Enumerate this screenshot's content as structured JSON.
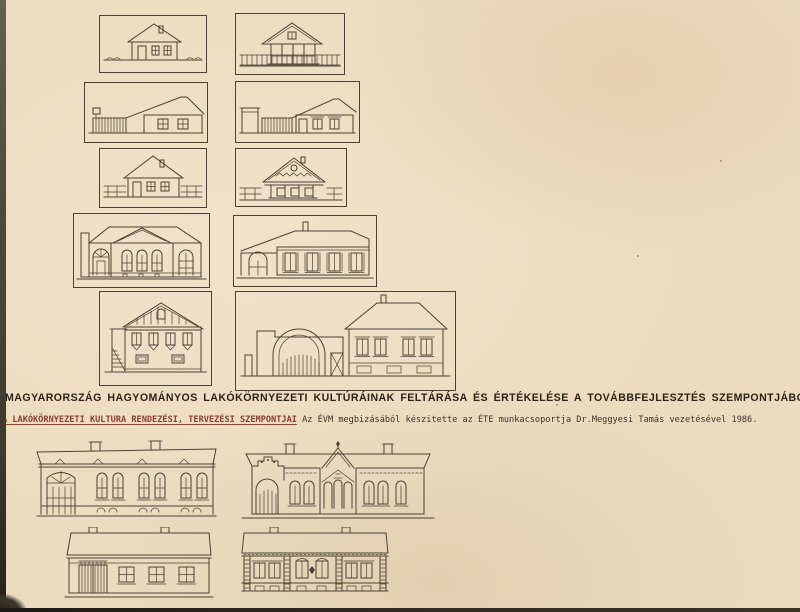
{
  "title": {
    "line1": "MAGYARORSZÁG HAGYOMÁNYOS LAKÓKÖRNYEZETI KULTÚRÁINAK FELTÁRÁSA ÉS ÉRTÉKELÉSE A TOVÁBBFEJLESZTÉS SZEMPONTJÁBÓL",
    "line2_underlined": "A LAKÓKÖRNYEZETI KULTURA RENDEZÉSI, TERVEZÉSI SZEMPONTJAI",
    "line2_rest": "  Az ÉVM megbizásából készitette az ÉTE munkacsoportja Dr.Meggyesi Tamás vezetésével 1986."
  },
  "colors": {
    "paper": "#ecdcbf",
    "ink": "#4b4237",
    "title_ink": "#2a231a",
    "underline_red": "#8c4130",
    "scan_edge": "#3b392e"
  },
  "figures": {
    "top_left_1": "hip-roof village house with chimney, door and two windows",
    "top_right_1": "gable-roof house with porch behind a picket fence",
    "top_left_2": "farmhouse side view with long sloping roof and plank gate",
    "top_right_2": "farmhouse with corner post, plank gate and two windows",
    "top_left_3": "tall hip-roof house with rail fences on both sides",
    "top_right_3": "house with decorated gable, round vent and porch posts",
    "top_left_4": "neoclassical mansion with pediment and arched openings",
    "top_right_4": "long manor house with arched doorway and four framed windows",
    "top_left_5": "two-story gabled house with plank gable and side stairs",
    "top_right_5": "walled yard with large arched gate and hip-roof dwelling house",
    "bottom_left_1": "eclectic street facade with tall arched gateway and three window bays",
    "bottom_right_1": "eclectic facade with central tower, spire and arched gateway",
    "bottom_left_2": "simple street facade with plank gate and three windows",
    "bottom_right_2": "street facade with paired decorated windows and rusticated piers"
  }
}
